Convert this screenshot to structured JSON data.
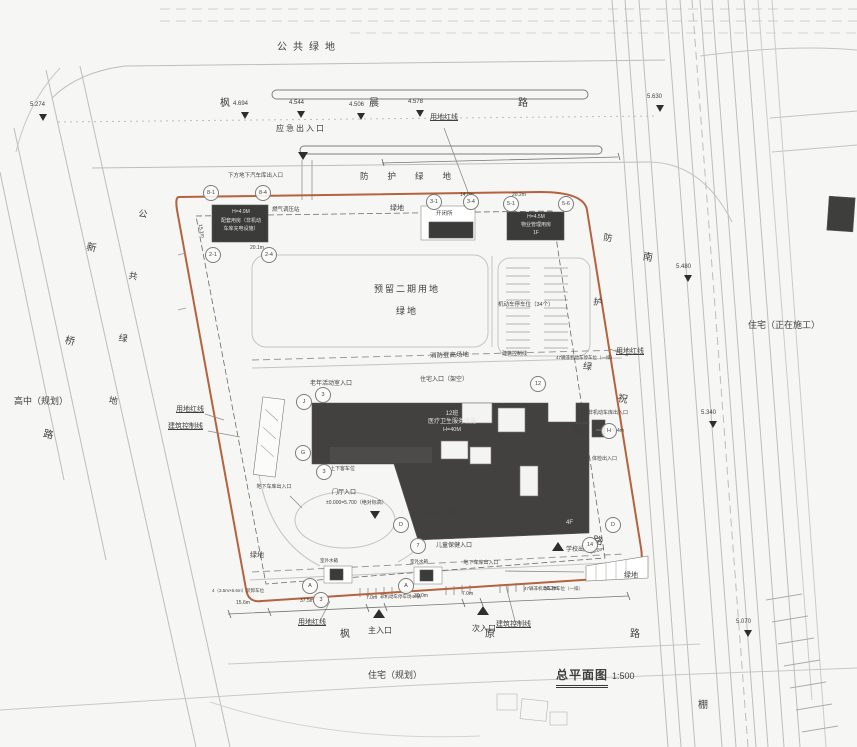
{
  "title": {
    "name": "总平面图",
    "scale": "1:500"
  },
  "roads": {
    "top": "枫晨路",
    "left": "新桥路",
    "right": "南祝路",
    "bottom": "枫原路"
  },
  "areas": {
    "public_green": "公共绿地",
    "protective_green": "防护绿地",
    "green": "绿地",
    "reserved_phase2": "预留二期用地",
    "high_school": "高中（规划）",
    "residential_construction": "住宅（正在施工）",
    "residential_planned": "住宅（规划）",
    "shed": "棚"
  },
  "boundary": {
    "red_line": "用地红线",
    "control_line": "建筑控制线"
  },
  "entrances": {
    "emergency": "应急出入口",
    "main": "主入口",
    "secondary": "次入口",
    "school": "学校出入口",
    "child_health": "儿童保健入口",
    "exam": "体检出入口",
    "lobby": "门厅入口",
    "resident_elevated": "住宅入口（架空）",
    "elderly_room": "老年活动室入口",
    "plaza": "入口广场",
    "garage": "地下车库出入口",
    "nonmotor_garage": "非机动车库出入口"
  },
  "site": {
    "parking_lot": "机动车停车位（34个）",
    "fire_lane": "消防登高场地",
    "nonmotor_parking_40": "非机动车停车场40辆",
    "nonmotor_row_47": "47辆非机动车停车位（一排）",
    "water_tank": "室外水箱",
    "loading_bay": "4（3.5m×6.6m）装卸车位",
    "gas_station": "燃气调压站",
    "ramp_note": "下方地下汽车库出入口",
    "drop_off": "上下客车位",
    "abs_elevation": "±0.000=5.700（绝对标高）"
  },
  "buildings": {
    "support": {
      "l1": "H=4.9M",
      "l2": "配套用房（非机动",
      "l3": "车库充电设施）"
    },
    "switch_station": "开闭所",
    "property": {
      "l1": "H=4.5M",
      "l2": "物业管理用房",
      "l3": "1F"
    },
    "main": {
      "l1": "12班",
      "l2": "医疗卫生服务设施",
      "l3": "H=40M",
      "floors": "4F"
    }
  },
  "elevations": {
    "e5274": "5.274",
    "e4694": "4.694",
    "e4544": "4.544",
    "e4506": "4.506",
    "e4578": "4.578",
    "e5630": "5.630",
    "e5480": "5.480",
    "e5340": "5.340",
    "e5070": "5.070"
  },
  "dimensions": {
    "d156": "15.6m",
    "d375": "37.5m",
    "d70": "7.0m",
    "d300": "30.0m",
    "d562": "56.2m",
    "d140": "14.0m",
    "d202": "20.2m",
    "d151": "15.1m",
    "d201": "20.1m",
    "d160": "16.0m",
    "d204": "20.4m"
  },
  "bubbles": {
    "b1": "8-1",
    "b2": "8-4",
    "b3": "2-1",
    "b4": "2-4",
    "b5": "3-1",
    "b6": "3-4",
    "b7": "5-1",
    "b8": "5-6",
    "b9": "J",
    "b10": "G",
    "b11": "H",
    "b12": "D",
    "b13": "D",
    "b14": "A",
    "b15": "A",
    "b16": "3",
    "b17": "3",
    "b18": "3",
    "b19": "7",
    "b20": "12",
    "b21": "14"
  }
}
